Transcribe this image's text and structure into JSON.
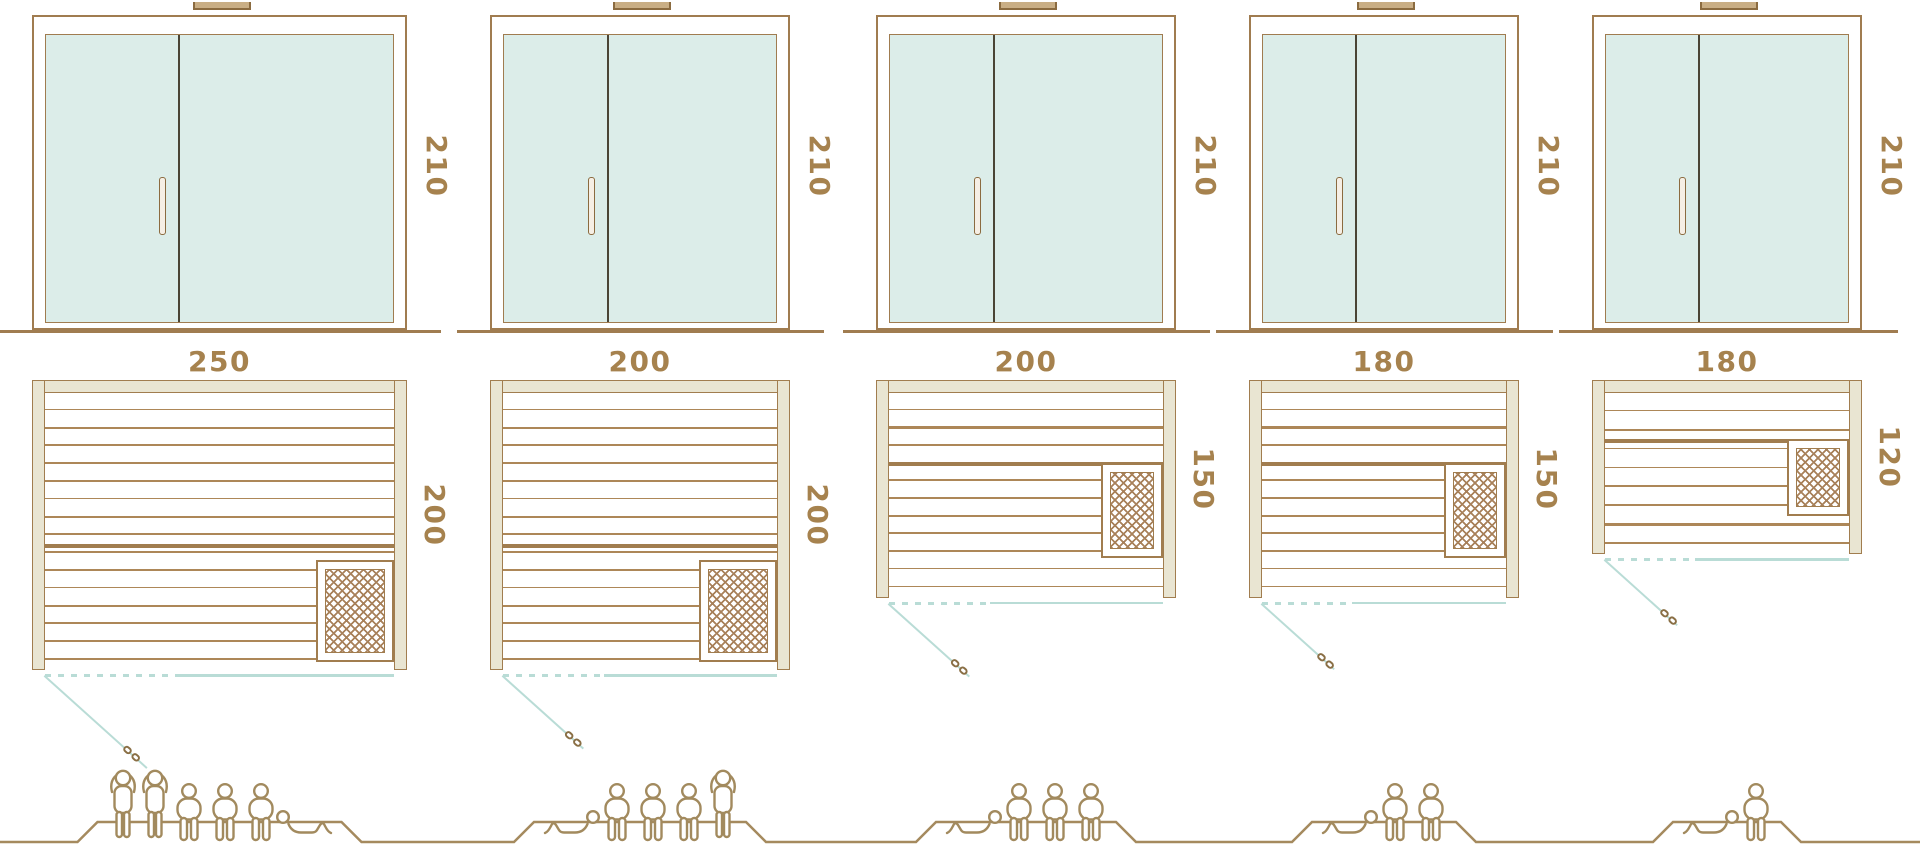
{
  "diagram": {
    "title": "sauna size comparison diagram",
    "rows": [
      "front elevation",
      "floor plan",
      "capacity figures"
    ],
    "door_height_label": "210",
    "colors": {
      "line_brown": "#a07c50",
      "dark_brown": "#8b6b40",
      "wall_beige": "#e9e5d2",
      "glass_mint": "#dcede9",
      "divider_dark": "#4a4435",
      "door_teal": "#b9dcd6",
      "label_brown": "#a6824e",
      "people_brown": "#a28a5e",
      "plank_brown": "#ad8758"
    },
    "saunas": [
      {
        "name": "sauna-250x200",
        "x": 32,
        "width_cm": 250,
        "depth_cm": 200,
        "width_label": "250",
        "depth_label": "200",
        "height_label": "210",
        "heater": "bottom-right",
        "capacity": 6,
        "people": [
          "standing",
          "standing",
          "seated",
          "seated",
          "seated",
          "lying"
        ]
      },
      {
        "name": "sauna-200x200",
        "x": 490,
        "width_cm": 200,
        "depth_cm": 200,
        "width_label": "200",
        "depth_label": "200",
        "height_label": "210",
        "heater": "bottom-right",
        "capacity": 5,
        "people": [
          "lying",
          "seated",
          "seated",
          "seated",
          "standing"
        ]
      },
      {
        "name": "sauna-200x150",
        "x": 876,
        "width_cm": 200,
        "depth_cm": 150,
        "width_label": "200",
        "depth_label": "150",
        "height_label": "210",
        "heater": "right-middle",
        "capacity": 4,
        "people": [
          "lying",
          "seated",
          "seated",
          "seated"
        ]
      },
      {
        "name": "sauna-180x150",
        "x": 1249,
        "width_cm": 180,
        "depth_cm": 150,
        "width_label": "180",
        "depth_label": "150",
        "height_label": "210",
        "heater": "right-middle",
        "capacity": 3,
        "people": [
          "lying",
          "seated",
          "seated"
        ]
      },
      {
        "name": "sauna-180x120",
        "x": 1592,
        "width_cm": 180,
        "depth_cm": 120,
        "width_label": "180",
        "depth_label": "120",
        "height_label": "210",
        "heater": "right-middle",
        "capacity": 2,
        "people": [
          "lying",
          "seated"
        ]
      }
    ]
  }
}
